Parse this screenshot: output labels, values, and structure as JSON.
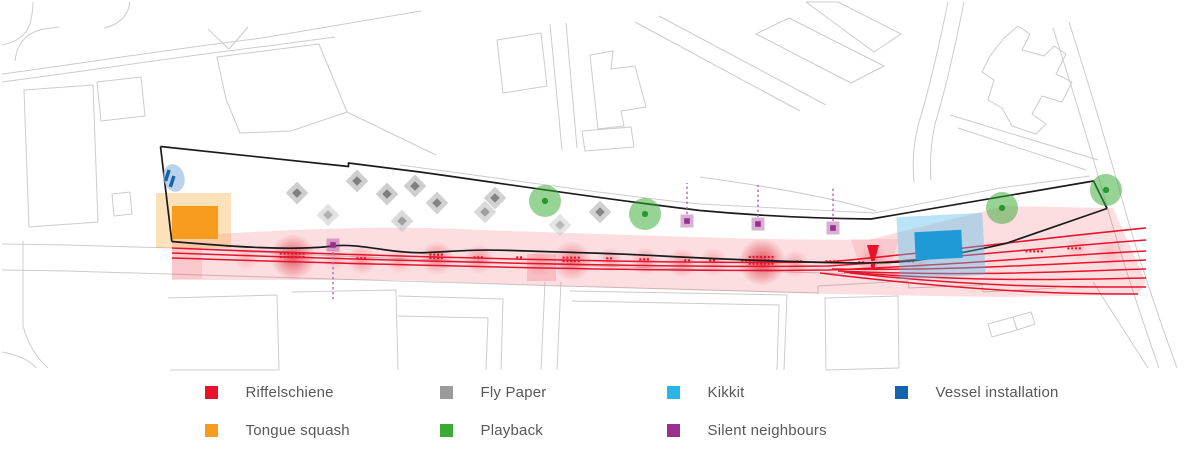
{
  "canvas": {
    "width": 1200,
    "height": 464
  },
  "legend": {
    "items": [
      {
        "id": "riffelschiene",
        "label": "Riffelschiene",
        "color": "#e8132b"
      },
      {
        "id": "tongue-squash",
        "label": "Tongue squash",
        "color": "#f79c1d"
      },
      {
        "id": "fly-paper",
        "label": "Fly Paper",
        "color": "#9b9b9b"
      },
      {
        "id": "playback",
        "label": "Playback",
        "color": "#3aaa35"
      },
      {
        "id": "kikkit",
        "label": "Kikkit",
        "color": "#29b5ea"
      },
      {
        "id": "silent-neighbours",
        "label": "Silent neighbours",
        "color": "#9b2f92"
      },
      {
        "id": "vessel-installation",
        "label": "Vessel installation",
        "color": "#1464ad"
      }
    ]
  },
  "map": {
    "colors": {
      "basemap": "#cccccc",
      "outline": "#1b1b1b",
      "red": "#e8132b",
      "red_dark": "#d50f1f",
      "orange": "#f79c1d",
      "cyan": "#1f9ad6",
      "cyan_glow": "#53bce8",
      "green": "#3aaa35",
      "green_dark": "#27982f",
      "gray_light": "#c6c6c6",
      "gray_dark": "#7f7f7f",
      "purple": "#95308e",
      "purple_line": "#b464b0",
      "blue": "#1464ad",
      "blue_soft": "#a3c3e5"
    },
    "basemap_paths": [
      "M2,74 C90,62 180,48 262,38 L421,11",
      "M2,82 C95,70 190,55 268,46 L335,37",
      "M15,61 Q18,34 44,29 L59,27",
      "M2,45 Q24,41 30,24 Q33,12 33,2",
      "M104,28 Q122,24 128,10 Q130,4 129,2",
      "M208,29 L229,49 L248,27",
      "M24,90 L93,85 L98,222 L29,227 Z",
      "M97,82 L141,77 L145,116 L101,121 Z",
      "M112,194 L130,192 L132,214 L114,216 Z",
      "M217,57 L319,44 L347,112 L291,131 L240,133 L226,99 Z",
      "M347,112 L436,155",
      "M497,40 L541,33 L547,86 L503,93 Z",
      "M550,24 L562,150",
      "M566,23 L577,148",
      "M590,55 L613,51 L611,69 L635,66 L646,107 L621,111 L624,126 L598,129 Z",
      "M582,131 L631,127 L634,147 L585,151 Z",
      "M635,22 L800,111",
      "M659,16 L826,105",
      "M756,34 L789,18 L884,66 L851,83 Z",
      "M806,2 L838,2 L901,34 L874,52 Z",
      "M948,2 Q932,80 919,122 Q911,152 914,182",
      "M964,2 Q948,82 935,124 Q929,152 931,180",
      "M990,56 L1004,38 L1018,26 L1030,34 L1022,50 L1044,56 L1054,46 L1066,54 L1056,74 L1072,82 L1062,102 L1042,96 L1032,114 L1046,124 L1036,134 L1012,126 L1002,108 L988,100 L994,80 L982,72 Z",
      "M950,115 L1098,160",
      "M958,128 L1086,170",
      "M1069,22 Q1097,110 1120,192 Q1142,272 1177,368",
      "M1053,28 Q1081,116 1104,196 Q1126,274 1159,368",
      "M1093,282 L1148,368",
      "M2,244 L67,245 L172,248 C400,260 700,270 865,274",
      "M2,270 L67,271 C250,276 400,281 560,286 C700,290 780,292 818,293",
      "M23,241 L23,326 Q30,352 48,368",
      "M2,352 Q26,356 36,368",
      "M168,298 L277,295 L279,370 L170,370",
      "M292,292 L396,290 L398,370",
      "M398,296 L503,299 L501,370",
      "M398,316 L488,318 L486,370",
      "M545,282 L541,370",
      "M561,282 L557,370",
      "M570,291 L787,295 L784,370",
      "M572,301 L779,305 L777,370",
      "M825,298 L898,296 L899,368 L826,370 Z",
      "M818,294 L818,286 L908,281 L909,288 L982,285 L983,292 L1056,288",
      "M988,324 L1013,317 L1017,330 L992,337 Z",
      "M1013,317 L1031,312 L1035,324 L1017,330 Z",
      "M400,165 C520,181 620,196 700,204 L874,213 L1000,188 L1090,176",
      "M700,177 C780,188 840,200 876,211"
    ],
    "site_outline": [
      "M160.5,146.5 L171.8,241.5",
      "M160.5,146.5 L348.5,166.5 L348.5,163 L420,172 C520,186 610,200 700,210.5 C760,216 820,218.5 871,219 L1093.5,181 L1107,208.5",
      "M171.8,241.5 C230,246.5 292,251 333,246 C360,242.8 392,254 426,252.6 C456,251.4 472,249 516,250.6 C562,252.2 612,253.2 662,256 C712,258.6 782,261.6 832,262.6 C872,263.4 902,263 927,258.8 C957,253.8 986,248 1006,243.4 L1107,208.5"
    ],
    "riffelschiene": {
      "band_path": "M172,237 C300,228 380,227 430,228 C560,233 660,236 760,239 L868,240 L1005,206 L1113,208 L1146,282 L1138,295 L1000,297 C900,296 700,291 500,284 L400,280 L172,280 Z",
      "band_opacity": 0.14,
      "soft_patches": [
        [
          "M851,239 L899,239 L889,271 L861,271 Z",
          0.1
        ],
        [
          "M527,254 L556,254 L556,281 L527,281 Z",
          0.16
        ],
        [
          "M172,247 L202,247 L202,279 L172,279 Z",
          0.1
        ]
      ],
      "rails": [
        "M172,248 C420,258 680,264 828,262 C950,251 1050,237 1146,228",
        "M172,253 C420,262 680,268 828,266 C955,258 1060,246 1146,240",
        "M172,258 C420,266 680,272 828,270 C960,265 1060,255 1146,251",
        "M832,269 C960,271 1065,263 1146,260",
        "M838,271 C975,277 1075,271 1146,269",
        "M844,272 C985,283 1085,279 1146,278",
        "M850,273 C995,289 1095,287 1146,287",
        "M820,273 C1000,295 1100,294 1138,294"
      ],
      "blobs": [
        [
          293,
          257,
          23,
          0.8
        ],
        [
          246,
          258,
          13,
          0.22
        ],
        [
          335,
          259,
          12,
          0.22
        ],
        [
          362,
          260,
          15,
          0.38
        ],
        [
          399,
          261,
          13,
          0.28
        ],
        [
          437,
          258,
          17,
          0.5
        ],
        [
          479,
          259,
          15,
          0.42
        ],
        [
          540,
          263,
          14,
          0.2
        ],
        [
          572,
          261,
          20,
          0.55
        ],
        [
          610,
          260,
          13,
          0.3
        ],
        [
          645,
          261,
          14,
          0.4
        ],
        [
          682,
          263,
          15,
          0.4
        ],
        [
          713,
          262,
          15,
          0.3
        ],
        [
          762,
          262,
          24,
          0.85
        ],
        [
          795,
          264,
          14,
          0.35
        ],
        [
          873,
          259,
          15,
          0.28
        ],
        [
          920,
          263,
          12,
          0.15
        ],
        [
          1078,
          248,
          14,
          0.18
        ],
        [
          1110,
          253,
          16,
          0.2
        ]
      ],
      "dot_clusters": [
        [
          293,
          256,
          7,
          2
        ],
        [
          362,
          259,
          3,
          1
        ],
        [
          437,
          257,
          4,
          2
        ],
        [
          479,
          258,
          3,
          1
        ],
        [
          520,
          258,
          2,
          1
        ],
        [
          572,
          260,
          5,
          2
        ],
        [
          610,
          259,
          2,
          1
        ],
        [
          645,
          260,
          3,
          1
        ],
        [
          688,
          261,
          2,
          1
        ],
        [
          713,
          261,
          2,
          1
        ],
        [
          745,
          261,
          2,
          1
        ],
        [
          762,
          261,
          7,
          3
        ],
        [
          800,
          262,
          2,
          1
        ],
        [
          833,
          262,
          4,
          1
        ],
        [
          862,
          263,
          2,
          1
        ],
        [
          912,
          262,
          2,
          1
        ],
        [
          1035,
          252,
          5,
          1
        ],
        [
          1075,
          249,
          4,
          1
        ]
      ],
      "warning_marker": {
        "x": 873,
        "y": 245
      }
    },
    "tongue_squash": {
      "glow": [
        156,
        193,
        75,
        55
      ],
      "rect": [
        172,
        206,
        46,
        33
      ]
    },
    "kikkit": {
      "glow": [
        898,
        215,
        86,
        62
      ],
      "rect": [
        915,
        231,
        47,
        28
      ],
      "rotation": -3
    },
    "fly_paper": [
      [
        297,
        193,
        1
      ],
      [
        357,
        181,
        1
      ],
      [
        387,
        194,
        1
      ],
      [
        328,
        215,
        0.6
      ],
      [
        402,
        221,
        0.75
      ],
      [
        415,
        186,
        1
      ],
      [
        437,
        203,
        0.95
      ],
      [
        485,
        212,
        0.75
      ],
      [
        495,
        198,
        0.95
      ],
      [
        560,
        225,
        0.55
      ],
      [
        600,
        212,
        0.95
      ]
    ],
    "playback": [
      [
        545,
        201,
        16
      ],
      [
        645,
        214,
        16
      ],
      [
        1002,
        208,
        16
      ],
      [
        1106,
        190,
        16
      ]
    ],
    "silent_neighbours": [
      {
        "x": 333,
        "y": 245,
        "dir": "down",
        "len": 50
      },
      {
        "x": 687,
        "y": 221,
        "dir": "up",
        "len": 31
      },
      {
        "x": 758,
        "y": 224,
        "dir": "up",
        "len": 32
      },
      {
        "x": 833,
        "y": 228,
        "dir": "up",
        "len": 34
      }
    ],
    "vessel_installation": {
      "cx": 174,
      "cy": 178,
      "rx": 10.5,
      "ry": 14,
      "bars": [
        [
          167.5,
          169.5
        ],
        [
          172.3,
          175.5
        ]
      ]
    }
  }
}
